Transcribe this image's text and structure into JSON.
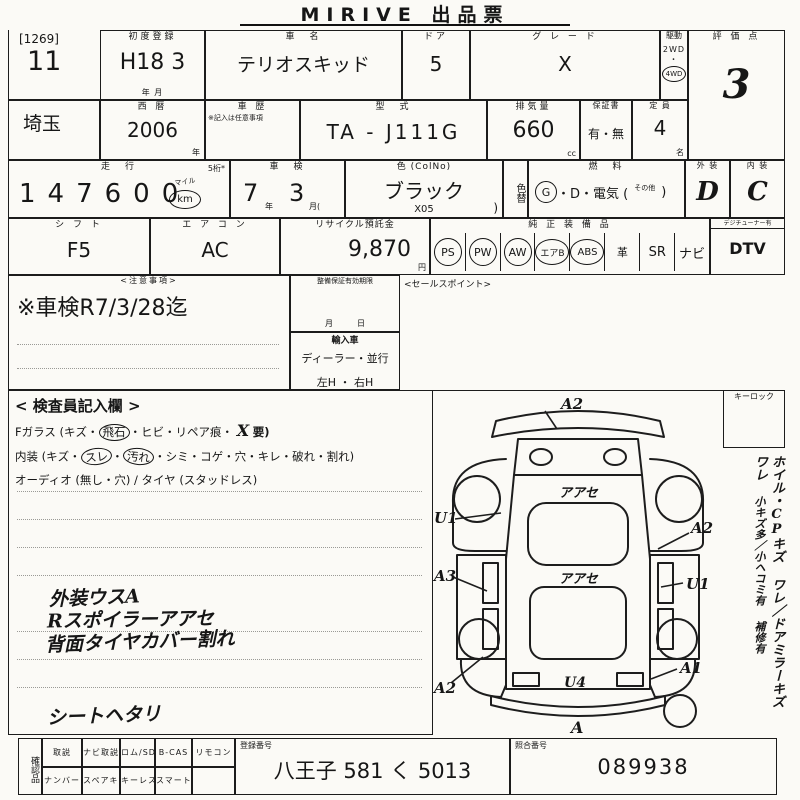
{
  "title": "MIRIVE 出品票",
  "lot": {
    "ref": "[1269]",
    "no": "11"
  },
  "r1": {
    "first_reg_label": "初度登録",
    "first_reg_value": "H18 3",
    "first_reg_units": "年        月",
    "name_label": "車　名",
    "name_value": "テリオスキッド",
    "door_label": "ドア",
    "door_value": "5",
    "grade_label": "グ レ ー ド",
    "grade_value": "X",
    "drive_label": "駆動",
    "drive_2wd": "2WD",
    "drive_dot": "・",
    "drive_4wd": "4WD",
    "score_label": "評 価 点",
    "score_value": "3"
  },
  "r2": {
    "pref": "埼玉",
    "year_label": "西 暦",
    "year_value": "2006",
    "year_unit": "年",
    "hist_label": "車 歴",
    "hist_note": "※記入は任意事項",
    "model_label": "型　式",
    "model_value": "TA - J111G",
    "disp_label": "排気量",
    "disp_value": "660",
    "disp_unit": "cc",
    "warr_label": "保証書",
    "warr_value": "有・無",
    "cap_label": "定 員",
    "cap_value": "4",
    "cap_unit": "名"
  },
  "r3": {
    "mile_label": "走　行",
    "mile_note": "5桁*",
    "mile_value": "147600",
    "mile_mile": "マイル",
    "mile_km": "km",
    "shaken_label": "車　検",
    "shaken_year": "7",
    "shaken_year_u": "年",
    "shaken_month": "3",
    "shaken_month_u": "月(",
    "color_label": "色 (ColNo)",
    "color_value": "ブラック",
    "color_code": "X05",
    "color_paren": ")",
    "colorchg": "色替",
    "fuel_label": "燃　料",
    "fuel_g": "G",
    "fuel_rest": "・D・電気 (",
    "fuel_other": "その他",
    "fuel_close": ")",
    "ext_label": "外 装",
    "ext_value": "D",
    "int_label": "内 装",
    "int_value": "C"
  },
  "r4": {
    "shift_label": "シ フ ト",
    "shift_value": "F5",
    "ac_label": "エ ア コ ン",
    "ac_value": "AC",
    "rec_label": "リサイクル預託金",
    "rec_value": "9,870",
    "rec_unit": "円",
    "equip_label": "純 正 装 備 品",
    "equip": [
      {
        "t": "PS"
      },
      {
        "t": "PW"
      },
      {
        "t": "AW"
      },
      {
        "t": "エアB"
      },
      {
        "t": "ABS"
      },
      {
        "t": "革"
      },
      {
        "t": "SR"
      },
      {
        "t": "ナビ"
      }
    ],
    "dtv_note": "デジチューナー有",
    "dtv_value": "DTV"
  },
  "notes": {
    "caution_header": "<注意事項>",
    "caution_text": "※車検R7/3/28迄",
    "maint_header": "整備保証有効期限",
    "maint_units": "月　　　日",
    "import_header": "輸入車",
    "import_line1": "ディーラー・並行",
    "import_line2": "左H ・ 右H",
    "sales_header": "<セールスポイント>"
  },
  "inspector": {
    "header": "< 検査員記入欄 >",
    "fglass_pre": "Fガラス (キズ・",
    "fglass_circ": "飛石",
    "fglass_mid": "・ヒビ・リペア痕・",
    "fglass_hand": "X",
    "fglass_end": "要)",
    "interior_pre": "内装 (キズ・",
    "int_circ1": "スレ",
    "int_dot": "・",
    "int_circ2": "汚れ",
    "interior_end": "・シミ・コゲ・穴・キレ・破れ・割れ)",
    "audio_line": "オーディオ (無し・穴) / タイヤ (スタッドレス)",
    "hand1": "外装ウスA",
    "hand2": "Rスポイラーアアセ",
    "hand3": "背面タイヤカバー割れ",
    "hand4": "シートヘタリ"
  },
  "diagram": {
    "top": "A2",
    "front_left": "U1",
    "right_upper": "A2",
    "left_mid": "A3",
    "hood": "アアセ",
    "roof": "アアセ",
    "right_mid": "U1",
    "rear_left": "A2",
    "hatch": "U4",
    "rear_right": "A1",
    "bottom": "A"
  },
  "sidebar": {
    "keylock": "キーロック",
    "note1": "ホイル・CPキズ ワレ",
    "note2": "ドアミラーキズ ワレ",
    "note3": "小キズ多／小ヘコミ有",
    "note4": "補修有"
  },
  "footer": {
    "check_label": "確認品",
    "row1": [
      "取説",
      "ナビ取説",
      "ロム/SD",
      "B-CAS",
      "リモコン"
    ],
    "row2": [
      "ナンバー",
      "スペアキー",
      "キーレス",
      "スマートキー"
    ],
    "reg_label": "登録番号",
    "reg_value": "八王子 581 く 5013",
    "ref_label": "照合番号",
    "ref_value": "089938"
  }
}
